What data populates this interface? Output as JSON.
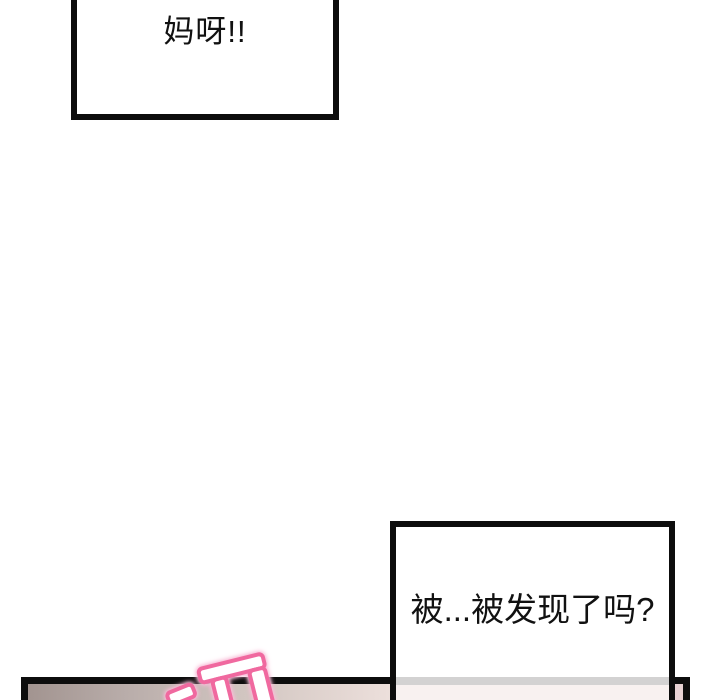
{
  "page": {
    "background_color": "#ffffff",
    "kind": "comic-page-fragment"
  },
  "bubbles": {
    "top": {
      "text": "妈呀!!"
    },
    "bottom": {
      "text": "被...被发现了吗?"
    }
  },
  "panel": {
    "border_color": "#0d0d0d",
    "gradient_colors": [
      "#a29490",
      "#b9adaa",
      "#d4c8c3",
      "#ecdfdb",
      "#f8ece8",
      "#e7d1d3"
    ],
    "showthrough_border_color": "#d3d2d2",
    "showthrough_fill_color": "#f8f1f0"
  },
  "sfx": {
    "label": "pink-impact-sound-effect",
    "fill_color": "#ffffff",
    "stroke_color": "#f0699f",
    "glow_color": "#f9bcd7"
  }
}
